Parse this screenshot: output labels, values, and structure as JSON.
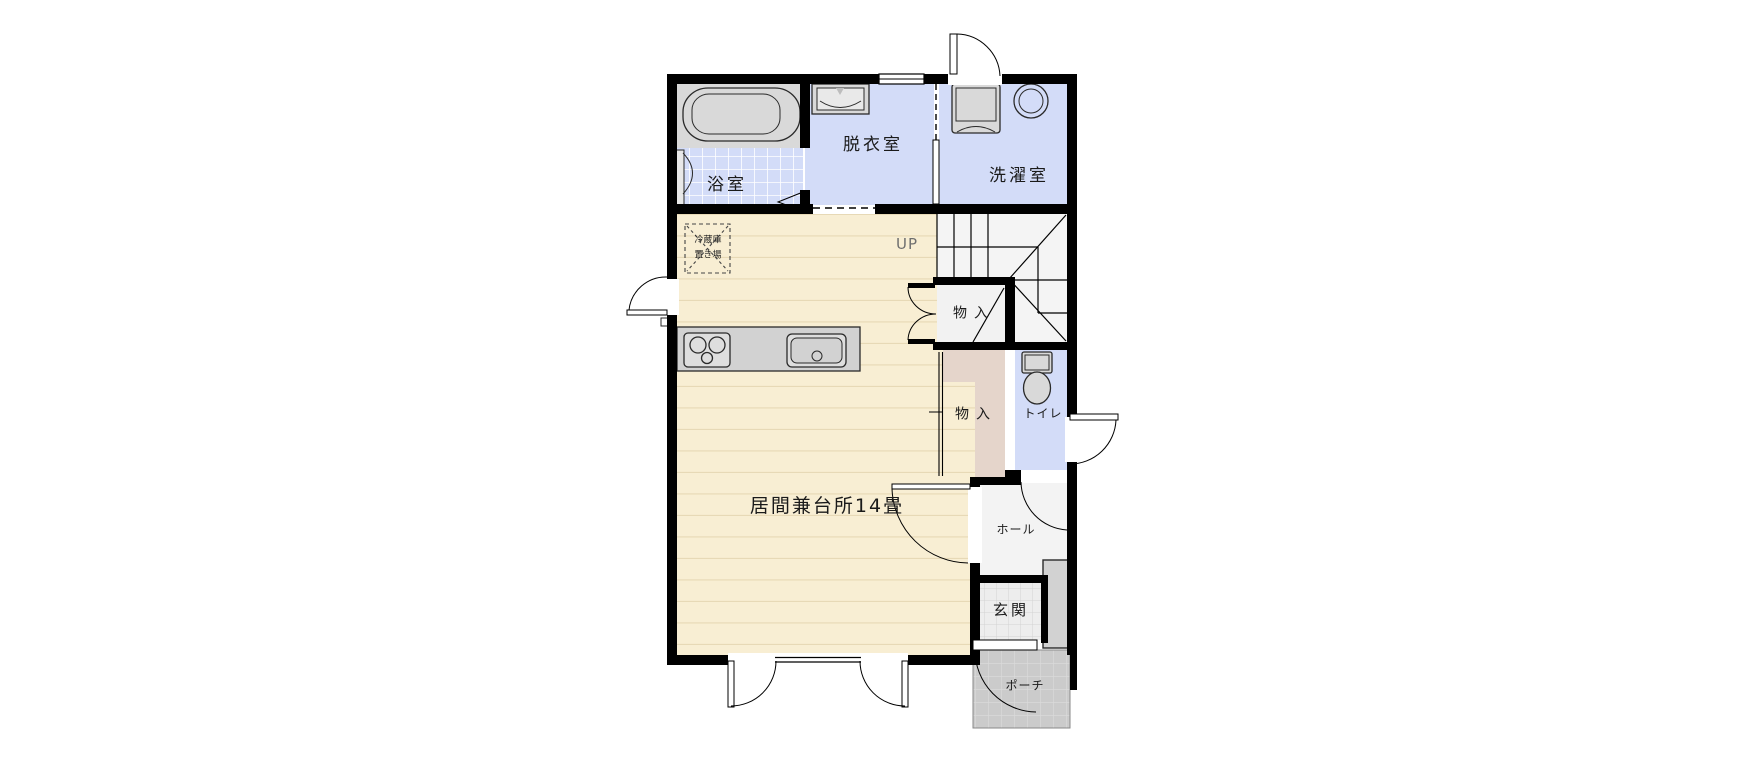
{
  "plan": {
    "rooms": {
      "bath": {
        "label": "浴室"
      },
      "dressing": {
        "label": "脱衣室"
      },
      "laundry": {
        "label": "洗濯室"
      },
      "stairs": {
        "label": "UP"
      },
      "closet_upper": {
        "label": "物入"
      },
      "closet_lower": {
        "label": "物入"
      },
      "toilet": {
        "label": "トイレ"
      },
      "living_kitchen": {
        "label": "居間兼台所14畳"
      },
      "hall": {
        "label": "ホール"
      },
      "entrance": {
        "label": "玄関"
      },
      "porch": {
        "label": "ポーチ"
      }
    },
    "annotations": {
      "fridge_space_line1": "冷蔵庫",
      "fridge_space_line2": "置き場"
    },
    "colors": {
      "wall": "#000000",
      "wood_floor": "#f8eed3",
      "wood_floor_line": "#e7d9b6",
      "wet_room_blue": "#d3dcf8",
      "closet_pink": "#e5d5cb",
      "fixture_gray": "#d9d9d9",
      "stair_floor": "#f4f4f4",
      "hall_floor": "#f3f3f3",
      "entrance_tile": "#ededed",
      "porch_tile": "#cbcbcb"
    }
  }
}
